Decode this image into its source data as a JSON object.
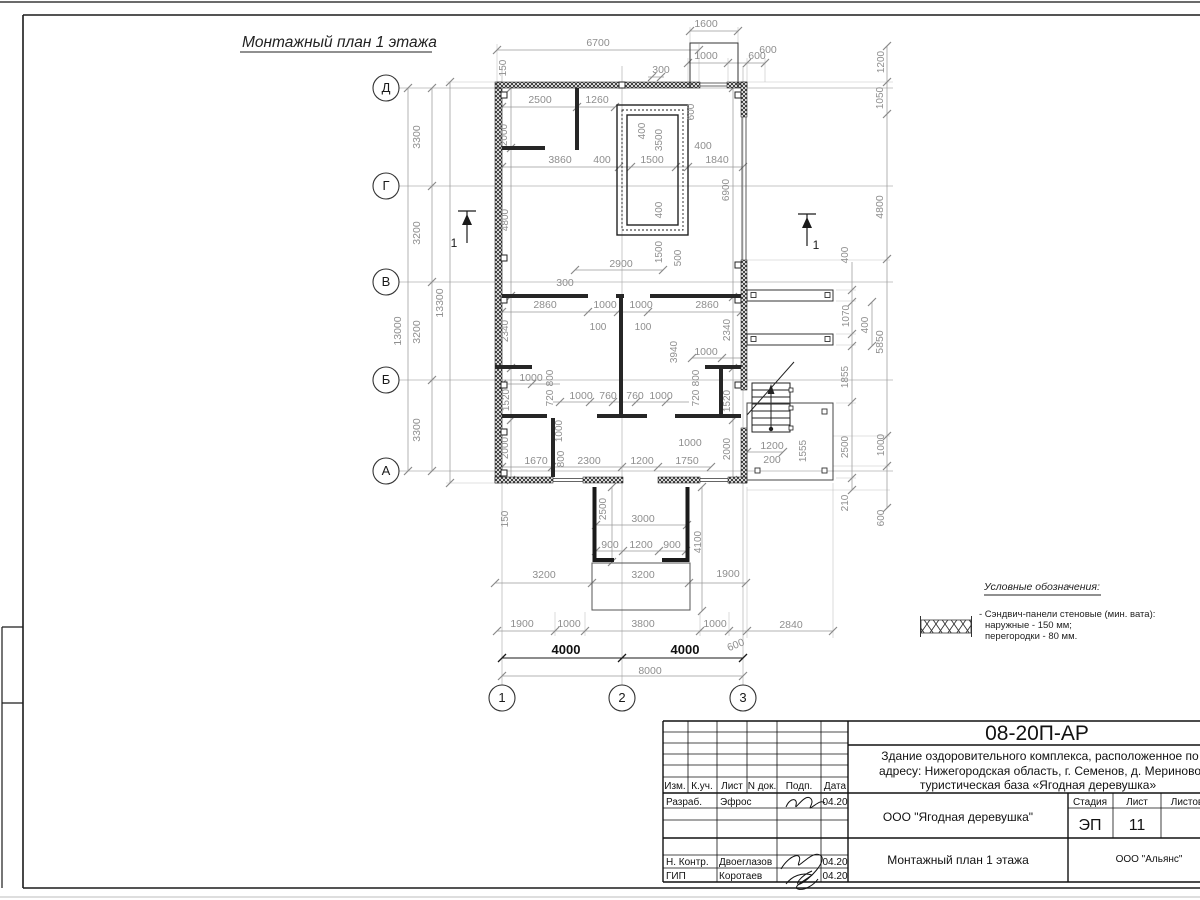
{
  "sheet": {
    "plan_title": "Монтажный план 1 этажа",
    "section_label": "1"
  },
  "axes": {
    "rows": [
      "Д",
      "Г",
      "В",
      "Б",
      "А"
    ],
    "cols": [
      "1",
      "2",
      "3"
    ]
  },
  "legend": {
    "title": "Условные обозначения:",
    "line1": "- Сэндвич-панели стеновые (мин. вата):",
    "line2": "наружные - 150 мм;",
    "line3": "перегородки - 80 мм."
  },
  "dims": {
    "top": [
      "1600",
      "6700",
      "1000",
      "600",
      "300",
      "150",
      "2500",
      "1260",
      "2000",
      "600",
      "400",
      "3500",
      "3860",
      "400",
      "1500",
      "400",
      "1840",
      "4800",
      "6900",
      "400",
      "1500",
      "500",
      "2900",
      "300"
    ],
    "mid": [
      "2860",
      "1000",
      "1000",
      "2860",
      "100",
      "100",
      "2340",
      "2340",
      "3940",
      "1000",
      "1000",
      "800",
      "720",
      "800",
      "720",
      "1520",
      "1520",
      "1000",
      "760",
      "760",
      "1000",
      "1000",
      "800",
      "2000",
      "2000",
      "1670",
      "2300",
      "1200",
      "1750",
      "1000"
    ],
    "bottom": [
      "150",
      "2500",
      "3000",
      "900",
      "1200",
      "900",
      "4100",
      "3200",
      "3200",
      "1900",
      "1900",
      "1000",
      "3800",
      "1000",
      "2840",
      "600",
      "4000",
      "4000",
      "8000"
    ],
    "left": [
      "3300",
      "3200",
      "3200",
      "3300",
      "13000",
      "13300"
    ],
    "right": [
      "600",
      "1200",
      "1050",
      "4800",
      "400",
      "1070",
      "400",
      "5850",
      "1855",
      "1200",
      "200",
      "1555",
      "2500",
      "1000",
      "210",
      "600"
    ]
  },
  "titleblock": {
    "code": "08-20П-АР",
    "project_line1": "Здание оздоровительного комплекса, расположенное по",
    "project_line2": "адресу: Нижегородская область, г. Семенов, д. Мериново",
    "project_line3": "туристическая база «Ягодная деревушка»",
    "company": "ООО \"Ягодная деревушка\"",
    "drawing_title": "Монтажный план 1 этажа",
    "contractor": "ООО \"Альянс\"",
    "stage_label": "Стадия",
    "stage_value": "ЭП",
    "sheet_label": "Лист",
    "sheet_value": "11",
    "sheets_label": "Листов",
    "col_izm": "Изм.",
    "col_kuch": "К.уч.",
    "col_list": "Лист",
    "col_ndok": "N док.",
    "col_podp": "Подп.",
    "col_data": "Дата",
    "row1_role": "Разраб.",
    "row1_name": "Эфрос",
    "row1_date": "04.20",
    "row2_role": "Н. Контр.",
    "row2_name": "Двоеглазов",
    "row2_date": "04.20",
    "row3_role": "ГИП",
    "row3_name": "Коротаев",
    "row3_date": "04.20"
  }
}
